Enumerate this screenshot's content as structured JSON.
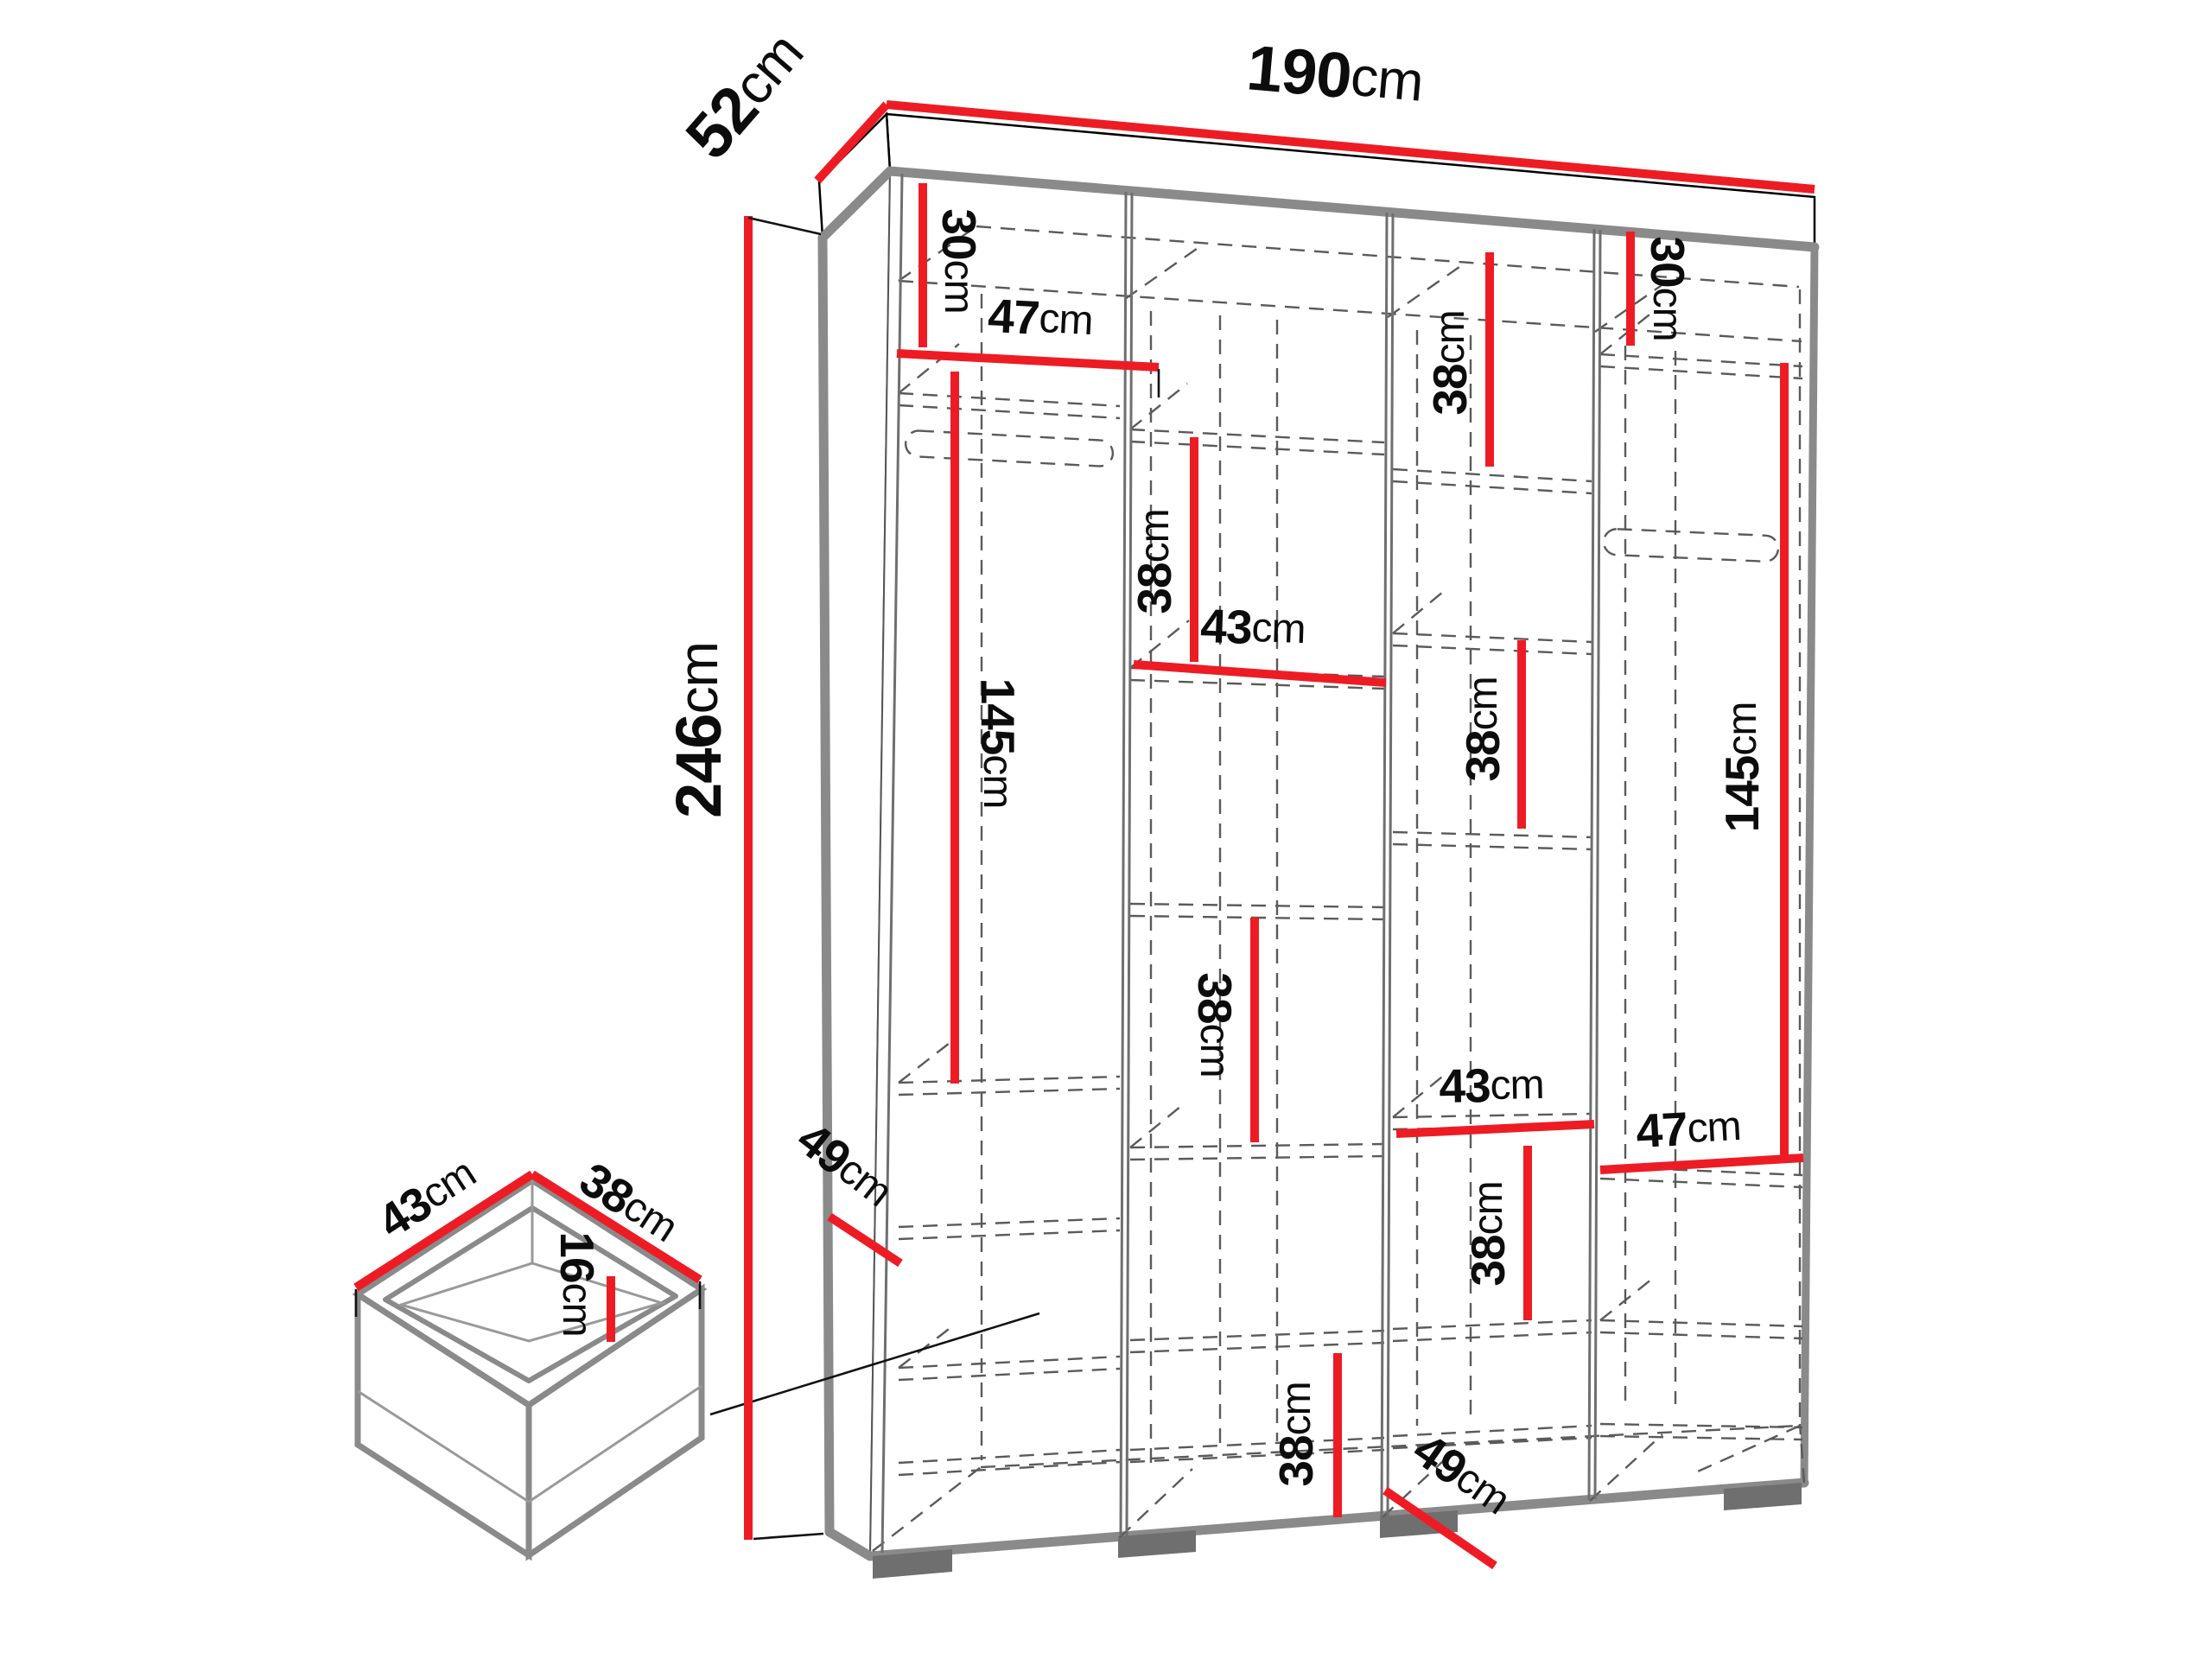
{
  "colors": {
    "dimension_red": "#ed1c24",
    "edge_gray": "#8a8a8a",
    "dashed_gray": "#5a5a5a"
  },
  "diagram": {
    "subject": "wardrobe-dimension-drawing",
    "unit_system": "cm"
  },
  "dims": {
    "width": {
      "v": "190",
      "u": "cm"
    },
    "depth": {
      "v": "52",
      "u": "cm"
    },
    "height": {
      "v": "246",
      "u": "cm"
    },
    "c1_top": {
      "v": "30",
      "u": "cm"
    },
    "c1_shelf_w": {
      "v": "47",
      "u": "cm"
    },
    "c1_hang": {
      "v": "145",
      "u": "cm"
    },
    "c2_upper": {
      "v": "38",
      "u": "cm"
    },
    "c2_shelf_w": {
      "v": "43",
      "u": "cm"
    },
    "c2_mid": {
      "v": "38",
      "u": "cm"
    },
    "c2_bottom": {
      "v": "38",
      "u": "cm"
    },
    "c3_top": {
      "v": "38",
      "u": "cm"
    },
    "c3_mid": {
      "v": "38",
      "u": "cm"
    },
    "c3_shelf_w": {
      "v": "43",
      "u": "cm"
    },
    "c3_lower": {
      "v": "38",
      "u": "cm"
    },
    "c4_top": {
      "v": "30",
      "u": "cm"
    },
    "c4_hang": {
      "v": "145",
      "u": "cm"
    },
    "c4_shelf_w": {
      "v": "47",
      "u": "cm"
    },
    "c1_shelf_depth": {
      "v": "49",
      "u": "cm"
    },
    "c4_shelf_depth": {
      "v": "49",
      "u": "cm"
    },
    "drawer_width": {
      "v": "43",
      "u": "cm"
    },
    "drawer_depth": {
      "v": "38",
      "u": "cm"
    },
    "drawer_height": {
      "v": "16",
      "u": "cm"
    }
  }
}
